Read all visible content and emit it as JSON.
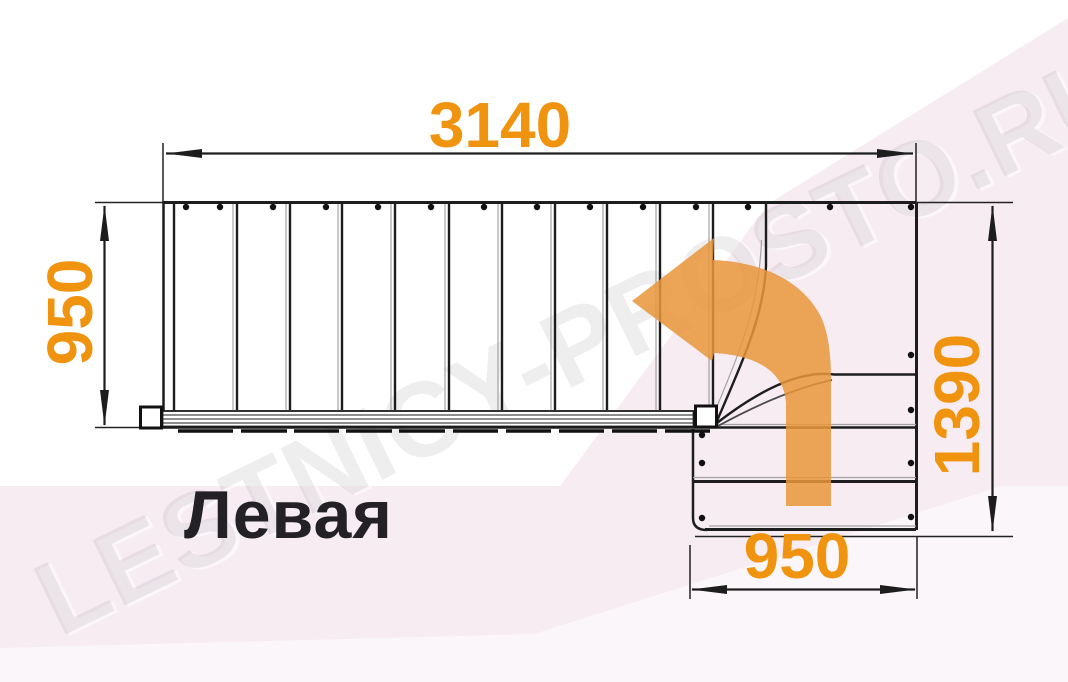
{
  "watermark_text": "LESTNICY-PROSTO.RU",
  "diagram": {
    "variant_label": "Левая",
    "dimensions": {
      "total_length": "3140",
      "flight_width": "950",
      "total_depth": "1390",
      "landing_width": "950"
    },
    "stairs": {
      "upper_straight_treads": 10,
      "winder_treads": 3,
      "lower_straight_treads": 2,
      "turn_direction": "left"
    },
    "colors": {
      "dimension_text": "#F0930F",
      "arrow_fill": "#E9963B",
      "linework": "#1D1D1D",
      "background_tint": "#F7ECF2"
    }
  }
}
